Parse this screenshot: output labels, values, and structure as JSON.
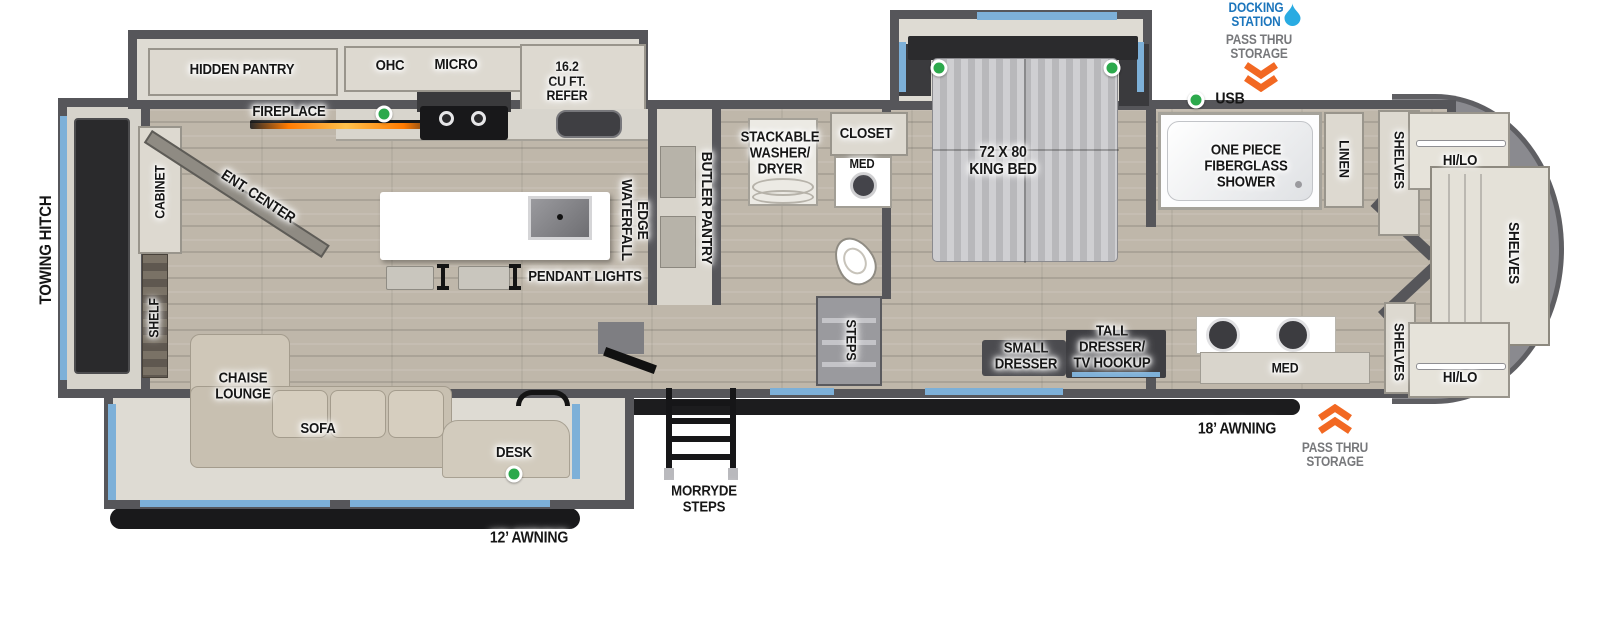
{
  "colors": {
    "accent_blue": "#7db0d8",
    "docking_blue": "#1b75bc",
    "storage_gray": "#77787b",
    "arrow_orange": "#f26822",
    "led_green": "#2ca94c"
  },
  "exterior": {
    "towing_hitch": "TOWING HITCH",
    "docking_station": "DOCKING\nSTATION",
    "pass_thru_storage_top": "PASS THRU\nSTORAGE",
    "usb_label": "USB",
    "awning_12": "12’ AWNING",
    "awning_18": "18’ AWNING",
    "morryde_steps": "MORRYDE\nSTEPS",
    "pass_thru_storage_bottom": "PASS THRU\nSTORAGE"
  },
  "living": {
    "hidden_pantry": "HIDDEN PANTRY",
    "fireplace": "FIREPLACE",
    "ent_center": "ENT. CENTER",
    "cabinet": "CABINET",
    "shelf": "SHELF",
    "chaise_lounge": "CHAISE\nLOUNGE",
    "sofa": "SOFA",
    "desk": "DESK"
  },
  "kitchen": {
    "ohc": "OHC",
    "micro": "MICRO",
    "refer": "16.2\nCU FT.\nREFER",
    "waterfall_edge": "WATERFALL\nEDGE",
    "pendant_lights": "PENDANT LIGHTS",
    "butler_pantry": "BUTLER PANTRY"
  },
  "bath_mid": {
    "washer_dryer": "STACKABLE\nWASHER/\nDRYER",
    "closet": "CLOSET",
    "med": "MED",
    "steps": "STEPS"
  },
  "bedroom": {
    "king_bed": "72 X 80\nKING BED",
    "small_dresser": "SMALL\nDRESSER",
    "tall_dresser": "TALL\nDRESSER/\nTV HOOKUP"
  },
  "bath_front": {
    "shower": "ONE PIECE\nFIBERGLASS\nSHOWER",
    "linen": "LINEN",
    "shelves_hall": "SHELVES",
    "med": "MED",
    "shelves_lower": "SHELVES"
  },
  "front_closet": {
    "hi_lo_top": "HI/LO",
    "shelves": "SHELVES",
    "hi_lo_bottom": "HI/LO"
  }
}
